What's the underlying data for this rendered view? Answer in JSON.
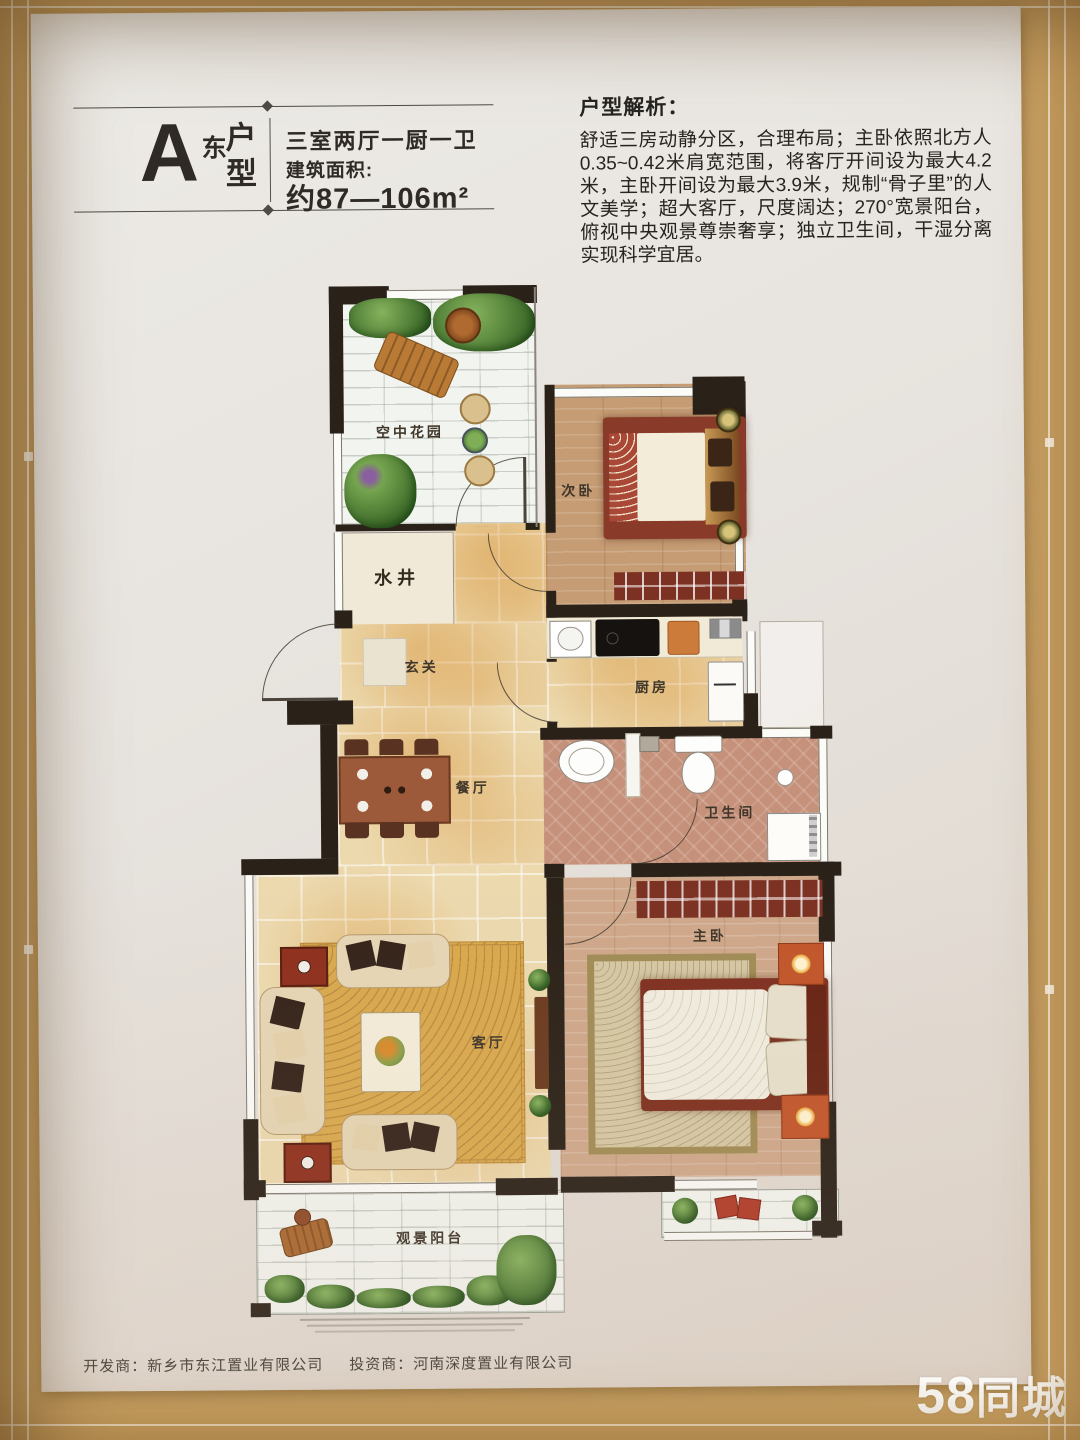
{
  "poster": {
    "title_block": {
      "letter": "A",
      "orientation": "东",
      "type_chars": "户型",
      "spec": "三室两厅一厨一卫",
      "area_label": "建筑面积:",
      "area_value": "约87—106m²"
    },
    "analysis": {
      "heading": "户型解析：",
      "body": "舒适三房动静分区，合理布局；主卧依照北方人0.35~0.42米肩宽范围，将客厅开间设为最大4.2米，主卧开间设为最大3.9米，规制“骨子里”的人文美学；超大客厅，尺度阔达；270°宽景阳台，俯视中央观景尊崇奢享；独立卫生间，干湿分离实现科学宜居。"
    },
    "floorplan": {
      "rooms": {
        "sky_garden": "空中花园",
        "well": "水井",
        "second_bedroom": "次卧",
        "foyer": "玄关",
        "kitchen": "厨房",
        "dining": "餐厅",
        "bathroom": "卫生间",
        "master_bedroom": "主卧",
        "living": "客厅",
        "balcony": "观景阳台"
      }
    },
    "footer": {
      "developer": "开发商：新乡市东江置业有限公司",
      "investor": "投资商：河南深度置业有限公司"
    }
  },
  "watermark": {
    "number": "58",
    "name": "同城"
  },
  "colors": {
    "frame": "#c8a164",
    "paper": "#e9e6e1",
    "wall": "#2a2118",
    "watermark": "#ffffff"
  }
}
